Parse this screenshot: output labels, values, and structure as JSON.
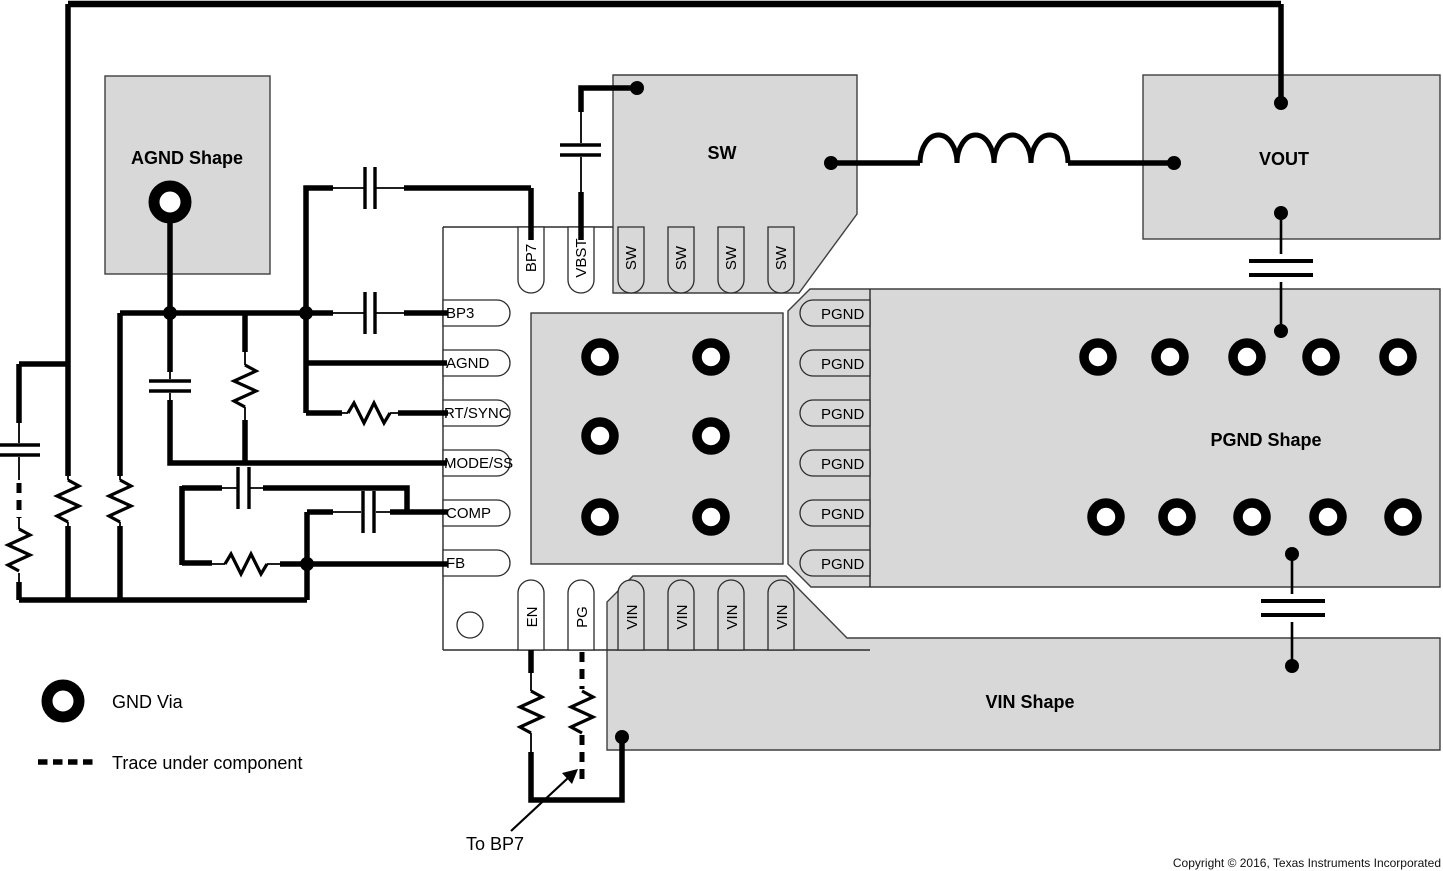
{
  "shapes": {
    "agnd_label": "AGND Shape",
    "sw_label": "SW",
    "vout_label": "VOUT",
    "pgnd_label": "PGND Shape",
    "vin_label": "VIN Shape"
  },
  "ic": {
    "pins": {
      "top": [
        "BP7",
        "VBST",
        "SW",
        "SW",
        "SW",
        "SW"
      ],
      "left": [
        "BP3",
        "AGND",
        "RT/SYNC",
        "MODE/SS",
        "COMP",
        "FB"
      ],
      "right": [
        "PGND",
        "PGND",
        "PGND",
        "PGND",
        "PGND",
        "PGND"
      ],
      "bottom": [
        "EN",
        "PG",
        "VIN",
        "VIN",
        "VIN",
        "VIN"
      ]
    }
  },
  "legend": {
    "gnd_via_label": "GND Via",
    "trace_label": "Trace under component"
  },
  "annotation": {
    "to_bp7": "To BP7"
  },
  "footer": {
    "copyright": "Copyright © 2016, Texas Instruments Incorporated"
  },
  "colors": {
    "shape_fill": "#d8d8d8",
    "shape_stroke": "#3f3f3f",
    "trace": "#000000",
    "background": "#ffffff"
  }
}
